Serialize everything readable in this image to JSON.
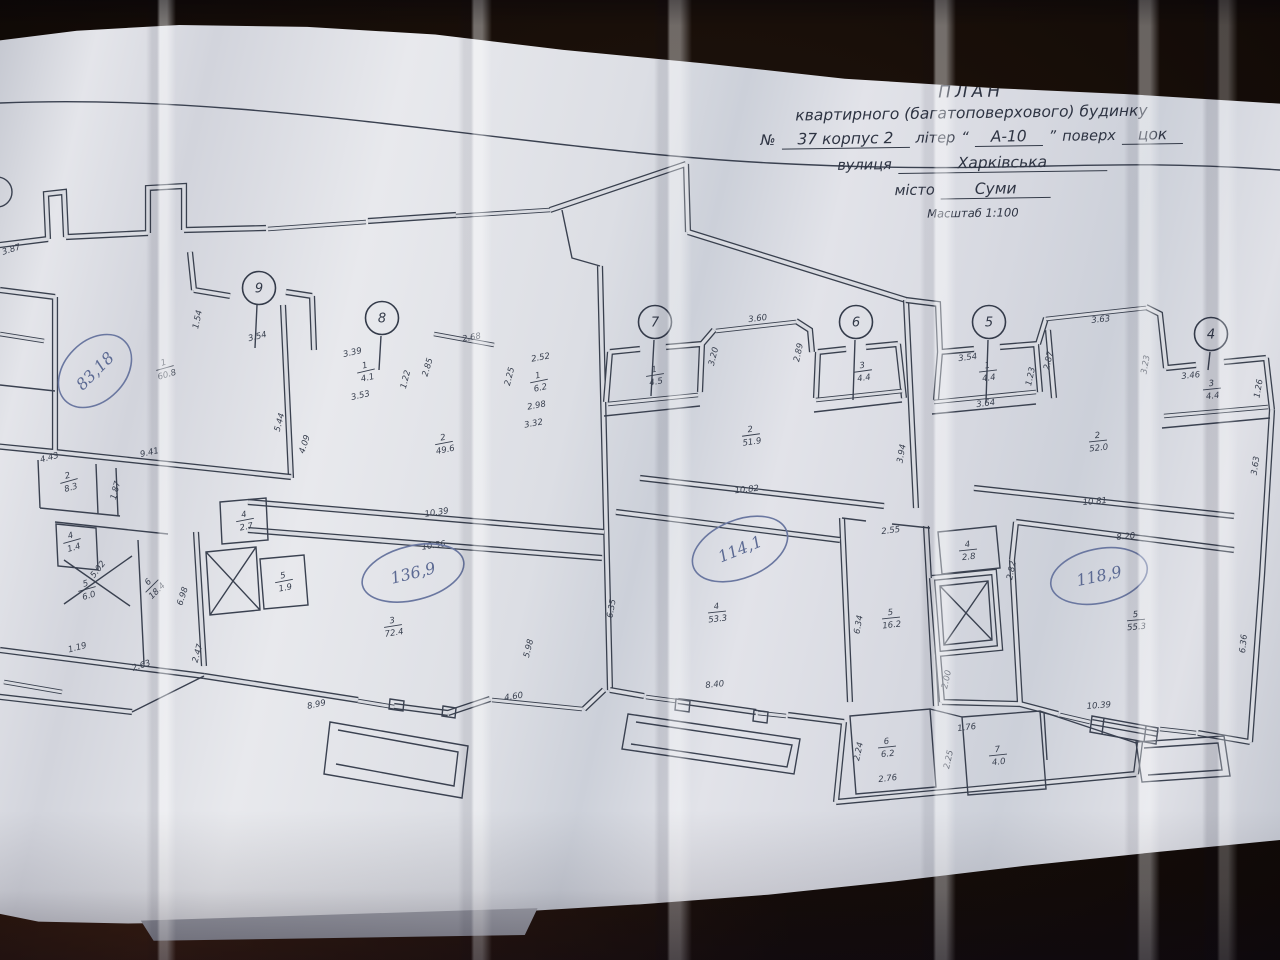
{
  "title_block": {
    "line1": "ПЛАН",
    "line2": "квартирного (багатоповерхового) будинку",
    "number_label": "№",
    "number": "37 корпус 2",
    "liter_label": "літер",
    "liter_quote_open": "“",
    "liter": "А-10",
    "liter_quote_close": "”",
    "floor_label": "поверх",
    "floor": "цок",
    "street_label": "вулиця",
    "street": "Харківська",
    "city_label": "місто",
    "city": "Суми",
    "scale": "Масштаб 1:100"
  },
  "plan": {
    "axes": {
      "a9": "9",
      "a8": "8",
      "a7": "7",
      "a6": "6",
      "a5": "5",
      "a4": "4"
    },
    "totals": {
      "t1": "83,18",
      "t2": "136,9",
      "t3": "114,1",
      "t4": "118,9"
    },
    "rooms": {
      "r1a": {
        "n": "1",
        "a": "60.8"
      },
      "r2a": {
        "n": "2",
        "a": "8.3"
      },
      "r4a": {
        "n": "4",
        "a": "1.4"
      },
      "r5a": {
        "n": "5",
        "a": "6.0"
      },
      "r6a": {
        "n": "6",
        "a": "18.4"
      },
      "r1b": {
        "n": "1",
        "a": "4.1"
      },
      "r1c": {
        "n": "1",
        "a": "6.2"
      },
      "r2b": {
        "n": "2",
        "a": "49.6"
      },
      "r4b": {
        "n": "4",
        "a": "2.7"
      },
      "r5b": {
        "n": "5",
        "a": "1.9"
      },
      "r3a": {
        "n": "3",
        "a": "72.4"
      },
      "r1d": {
        "n": "1",
        "a": "4.5"
      },
      "r2c": {
        "n": "2",
        "a": "51.9"
      },
      "r3b": {
        "n": "3",
        "a": "4.4"
      },
      "r4c": {
        "n": "4",
        "a": "53.3"
      },
      "r5c": {
        "n": "5",
        "a": "16.2"
      },
      "r1e": {
        "n": "1",
        "a": "4.4"
      },
      "r2d": {
        "n": "2",
        "a": "52.0"
      },
      "r3c": {
        "n": "3",
        "a": "4.4"
      },
      "r4d": {
        "n": "4",
        "a": "2.8"
      },
      "r5d": {
        "n": "5",
        "a": "55.3"
      },
      "r6b": {
        "n": "6",
        "a": "6.2"
      },
      "r7a": {
        "n": "7",
        "a": "4.0"
      }
    },
    "dims": {
      "d387": "3.87",
      "d154": "1.54",
      "d354a": "3.54",
      "d544": "5.44",
      "d409": "4.09",
      "d941": "9.41",
      "d443": "4.43",
      "d187": "1.87",
      "d339": "3.39",
      "d353": "3.53",
      "d122": "1.22",
      "d285": "2.85",
      "d268": "2.68",
      "d252": "2.52",
      "d225a": "2.25",
      "d298": "2.98",
      "d332": "3.32",
      "d1039a": "10.39",
      "d1056": "10.56",
      "d698": "6.98",
      "d247": "2.47",
      "d263": "2.63",
      "d119": "1.19",
      "d502": "5.02",
      "d899": "8.99",
      "d460": "4.60",
      "d598": "5.98",
      "d360": "3.60",
      "d320": "3.20",
      "d289": "2.89",
      "d394": "3.94",
      "d1082": "10.82",
      "d635": "6.35",
      "d840": "8.40",
      "d634": "6.34",
      "d255": "2.55",
      "d354b": "3.54",
      "d123": "1.23",
      "d364": "3.64",
      "d287": "2.87",
      "d363a": "3.63",
      "d323": "3.23",
      "d346": "3.46",
      "d126": "1.26",
      "d363b": "3.63",
      "d1081": "10.81",
      "d282": "2.82",
      "d820": "8.20",
      "d636": "6.36",
      "d200": "2.00",
      "d1039b": "10.39",
      "d176": "1.76",
      "d224": "2.24",
      "d276": "2.76",
      "d225b": "2.25"
    }
  }
}
